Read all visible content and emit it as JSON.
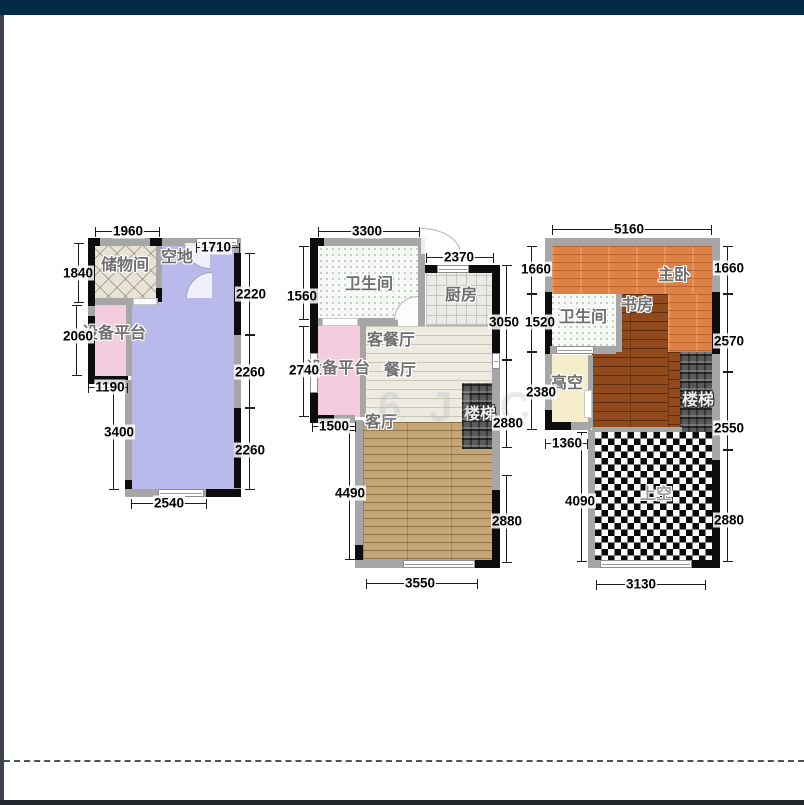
{
  "page": {
    "watermark_text": "6 JI C"
  },
  "colors": {
    "topbar": "#032a47",
    "leftstrip": "#3d434a",
    "bottombar": "#23282e",
    "lavender": "#b9b9ec",
    "pink": "#f3cddd",
    "orange": "#de8146",
    "brown": "#90491a",
    "yellow": "#f6eecb"
  },
  "plan1": {
    "rooms": {
      "storage": "储物间",
      "open_area": "空地",
      "equipment": "设备平台"
    },
    "dims": {
      "w1960": "1960",
      "w1710": "1710",
      "h1840": "1840",
      "h2060": "2060",
      "w1190": "1190",
      "h3400": "3400",
      "w2540": "2540",
      "h2220": "2220",
      "h2260a": "2260",
      "h2260b": "2260"
    }
  },
  "plan2": {
    "rooms": {
      "bathroom": "卫生间",
      "kitchen": "厨房",
      "living_dining": "客餐厅",
      "dining": "餐厅",
      "equipment": "设备平台",
      "living": "客厅",
      "stairs": "楼梯"
    },
    "dims": {
      "w3300": "3300",
      "w2370": "2370",
      "h1560": "1560",
      "h2740": "2740",
      "w1500": "1500",
      "h4490": "4490",
      "w3550": "3550",
      "h3050": "3050",
      "h2880a": "2880",
      "h2880b": "2880"
    }
  },
  "plan3": {
    "rooms": {
      "master": "主卧",
      "study": "书房",
      "bathroom": "卫生间",
      "high_void": "高空",
      "stairs": "楼梯",
      "void_above": "上空"
    },
    "dims": {
      "w5160": "5160",
      "h1660l": "1660",
      "h1520": "1520",
      "h2380": "2380",
      "w1360": "1360",
      "h4090": "4090",
      "h1660r": "1660",
      "h2570": "2570",
      "h2550": "2550",
      "h2880": "2880",
      "w3130": "3130"
    }
  }
}
